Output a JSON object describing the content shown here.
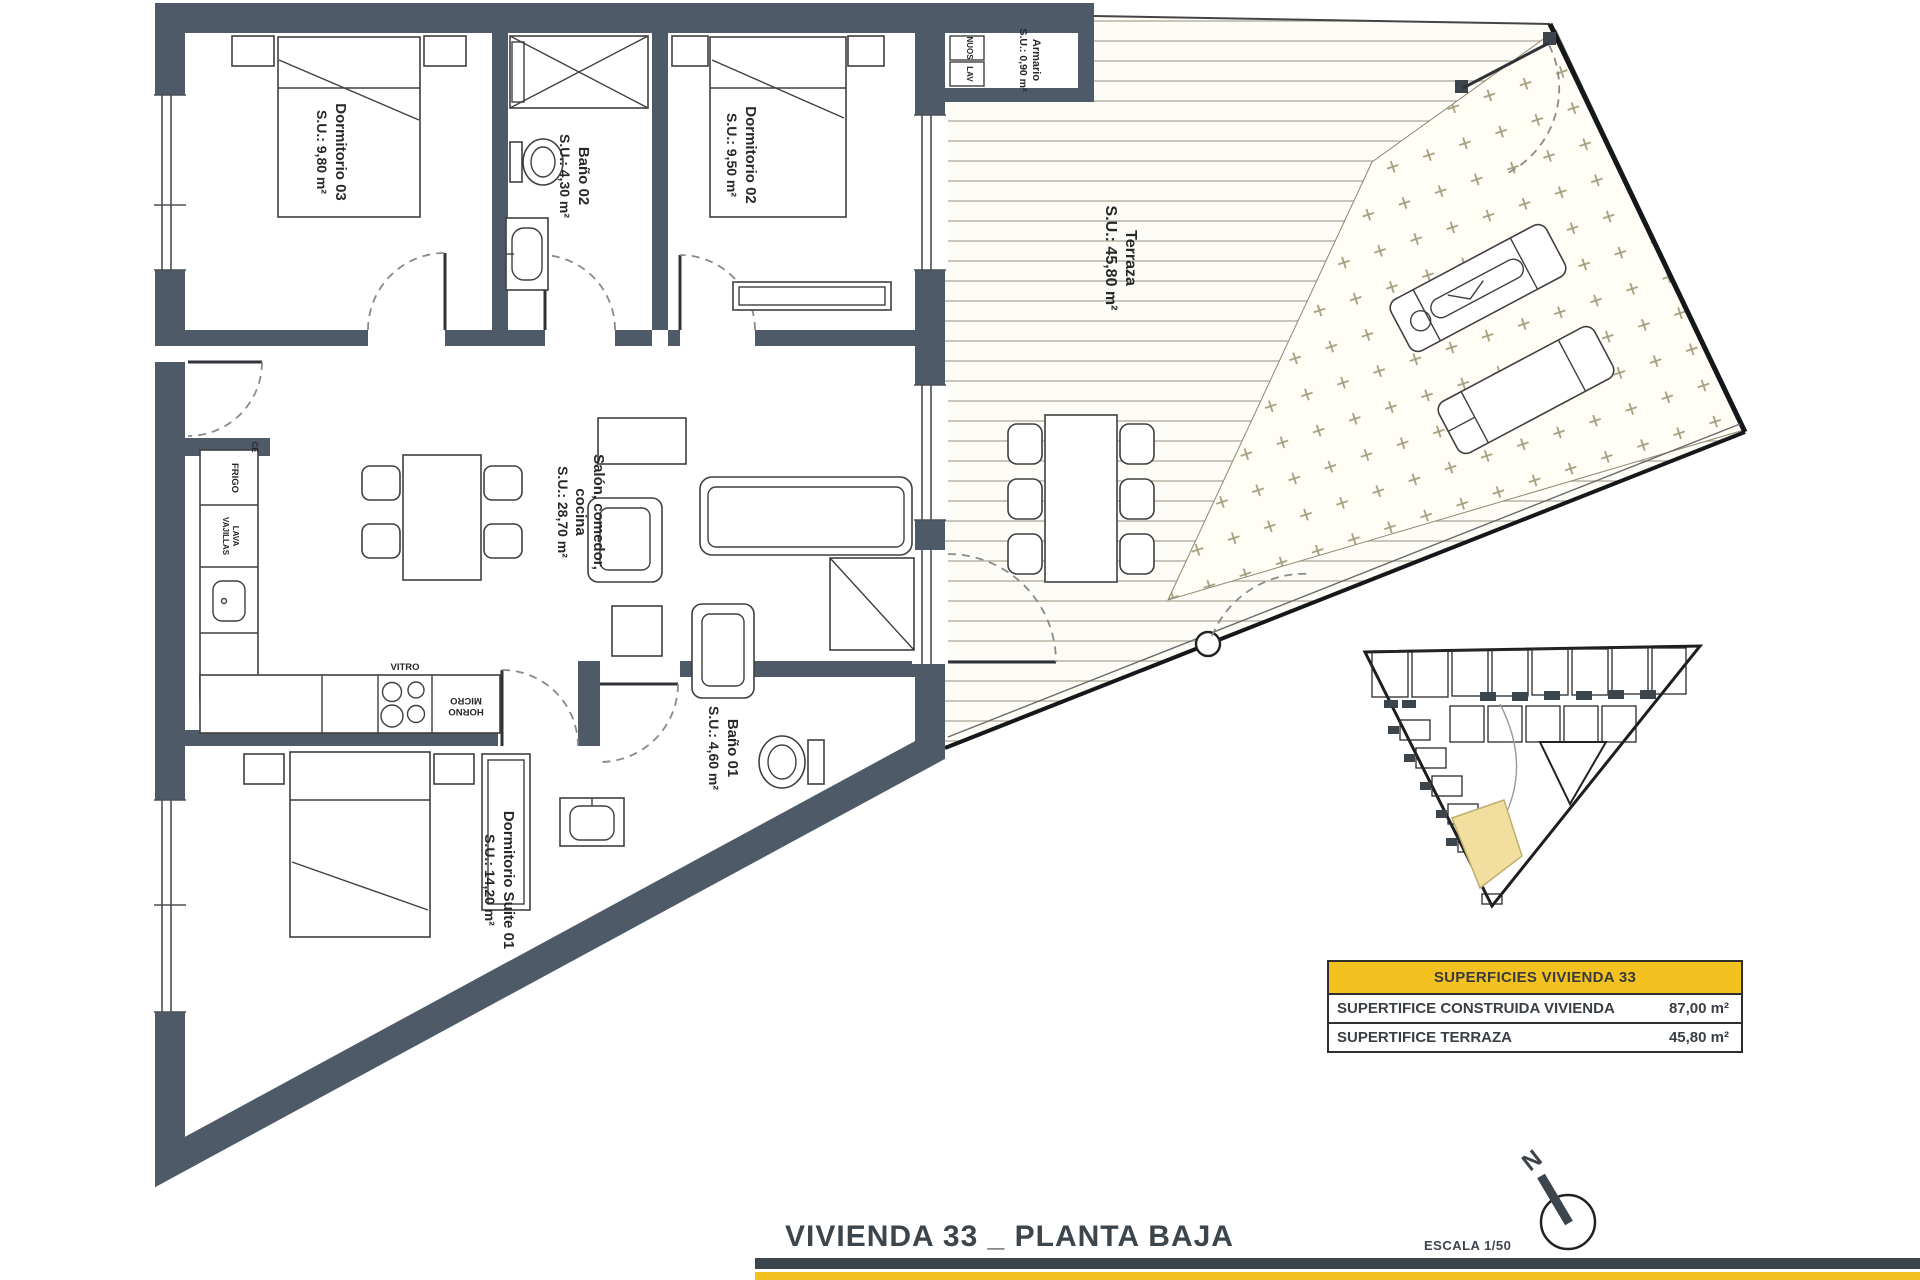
{
  "sheet": {
    "title": "VIVIENDA 33 _ PLANTA BAJA",
    "scale_label": "ESCALA 1/50",
    "north_label": "N"
  },
  "rooms": {
    "dormitorio03": {
      "label": "Dormitorio 03",
      "area": "S.U.: 9,80 m²"
    },
    "bano02": {
      "label": "Baño 02",
      "area": "S.U.: 4,30 m²"
    },
    "dormitorio02": {
      "label": "Dormitorio 02",
      "area": "S.U.: 9,50 m²"
    },
    "armario": {
      "label": "Armario",
      "area": "S.U.: 0,90 m²"
    },
    "terraza": {
      "label": "Terraza",
      "area": "S.U.: 45,80 m²"
    },
    "salon": {
      "label_line1": "Salón, comedor,",
      "label_line2": "cocina",
      "area": "S.U.: 28,70 m²"
    },
    "bano01": {
      "label": "Baño 01",
      "area": "S.U.: 4,60 m²"
    },
    "suite": {
      "label": "Dormitorio Suite 01",
      "area": "S.U.: 14,20 m²"
    }
  },
  "kitchen": {
    "frigo": "FRIGO",
    "lava_line1": "LAVA",
    "lava_line2": "VAJILLAS",
    "vitro": "VITRO",
    "horno_line1": "HORNO",
    "horno_line2": "MICRO",
    "ce": "CE"
  },
  "armario_fittings": {
    "nuos": "NUOS",
    "lav": "LAV"
  },
  "surfaces_table": {
    "header": "SUPERFICIES VIVIENDA 33",
    "rows": [
      {
        "label": "SUPERTIFICE CONSTRUIDA VIVIENDA",
        "value": "87,00 m²"
      },
      {
        "label": "SUPERTIFICE TERRAZA",
        "value": "45,80 m²"
      }
    ]
  },
  "colors": {
    "wall": "#4e5a68",
    "accent_yellow": "#f3c220",
    "highlight_unit": "#f2dfa0",
    "deck_line": "#b7b3a5",
    "grass_symbol": "#a59e7e"
  }
}
